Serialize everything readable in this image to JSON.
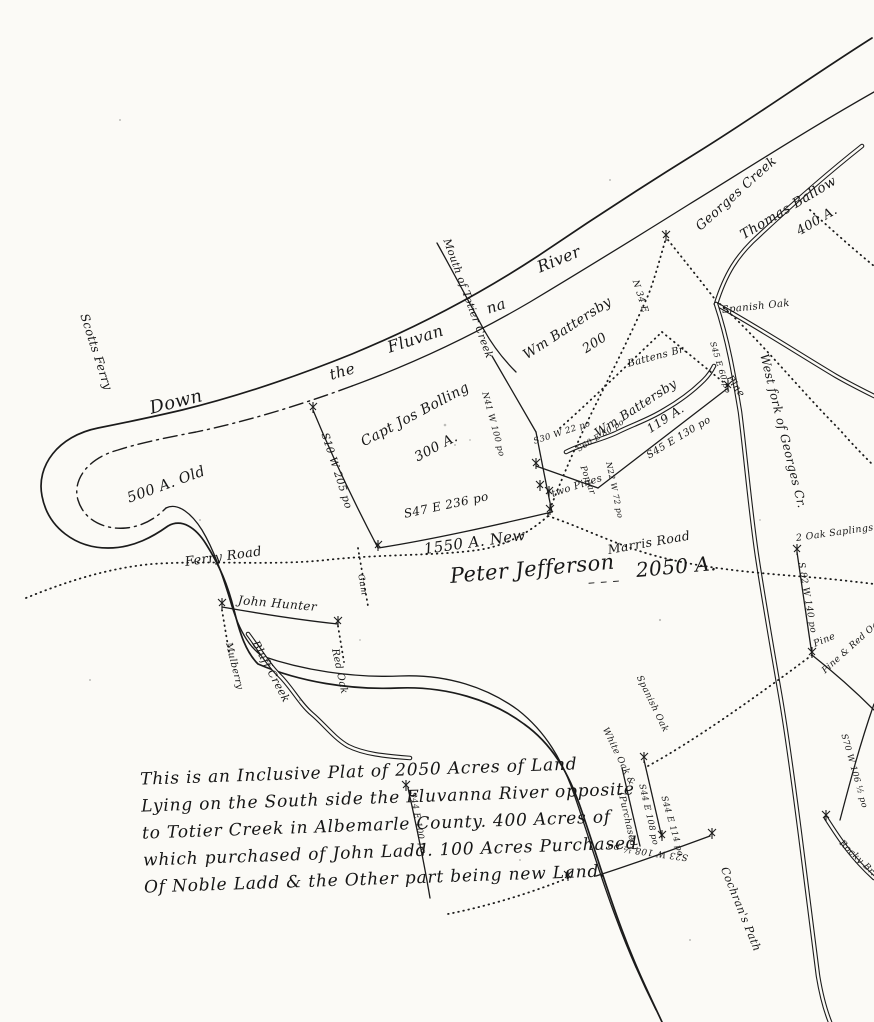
{
  "map": {
    "background_color": "#fbfaf6",
    "ink_color": "#1b1b1b",
    "note_lines": [
      "This is an Inclusive Plat of 2050 Acres of Land",
      "Lying on the South side the Fluvanna River opposite",
      "to Totier Creek in Albemarle County. 400 Acres of",
      "which purchased of John Ladd. 100 Acres Purchased",
      "Of Noble Ladd & the Other part being new Land."
    ],
    "labels": [
      {
        "name": "river-word-down",
        "text": "Down",
        "x": 150,
        "y": 400,
        "rot": -14,
        "fs": 18
      },
      {
        "name": "river-word-the",
        "text": "the",
        "x": 330,
        "y": 368,
        "rot": -16,
        "fs": 15
      },
      {
        "name": "river-word-fluvan",
        "text": "Fluvan",
        "x": 388,
        "y": 340,
        "rot": -18,
        "fs": 16
      },
      {
        "name": "river-word-na",
        "text": "na",
        "x": 487,
        "y": 302,
        "rot": -18,
        "fs": 15
      },
      {
        "name": "river-word-river",
        "text": "River",
        "x": 538,
        "y": 260,
        "rot": -22,
        "fs": 16
      },
      {
        "name": "scotts-ferry-label",
        "text": "Scotts Ferry",
        "x": 84,
        "y": 308,
        "rot": 72,
        "fs": 12
      },
      {
        "name": "totier-creek-label",
        "text": "Mouth of Totier Creek",
        "x": 446,
        "y": 234,
        "rot": 70,
        "fs": 10.5
      },
      {
        "name": "georges-creek-label",
        "text": "Georges Creek",
        "x": 698,
        "y": 222,
        "rot": -42,
        "fs": 13
      },
      {
        "name": "thomas-ballow-name",
        "text": "Thomas Ballow",
        "x": 742,
        "y": 230,
        "rot": -31,
        "fs": 13.5
      },
      {
        "name": "thomas-ballow-acres",
        "text": "400 A.",
        "x": 798,
        "y": 226,
        "rot": -31,
        "fs": 13
      },
      {
        "name": "battersby-200-name",
        "text": "Wm Battersby",
        "x": 525,
        "y": 350,
        "rot": -33,
        "fs": 13.5
      },
      {
        "name": "battersby-200-acres",
        "text": "200",
        "x": 584,
        "y": 344,
        "rot": -33,
        "fs": 13
      },
      {
        "name": "bearing-n34e",
        "text": "N 34 E",
        "x": 634,
        "y": 276,
        "rot": 72,
        "fs": 9
      },
      {
        "name": "spanish-oak-label",
        "text": "Spanish Oak",
        "x": 722,
        "y": 306,
        "rot": -6,
        "fs": 10
      },
      {
        "name": "bearing-s45e60",
        "text": "S45 E 60 po",
        "x": 712,
        "y": 338,
        "rot": 73,
        "fs": 8
      },
      {
        "name": "pine-upper-label",
        "text": "Pine",
        "x": 728,
        "y": 372,
        "rot": 55,
        "fs": 10
      },
      {
        "name": "west-fork-label",
        "text": "West fork of Georges Cr.",
        "x": 764,
        "y": 348,
        "rot": 76,
        "fs": 12
      },
      {
        "name": "battens-branch-label",
        "text": "Battens Br.",
        "x": 628,
        "y": 360,
        "rot": -15,
        "fs": 10
      },
      {
        "name": "battersby-119-name",
        "text": "Wm Battersby",
        "x": 596,
        "y": 428,
        "rot": -33,
        "fs": 12.5
      },
      {
        "name": "battersby-119-acres",
        "text": "119 A.",
        "x": 648,
        "y": 424,
        "rot": -33,
        "fs": 12
      },
      {
        "name": "bearing-s45e130",
        "text": "S45 E 130 po",
        "x": 648,
        "y": 452,
        "rot": -31,
        "fs": 10
      },
      {
        "name": "bolling-name",
        "text": "Capt Jos Bolling",
        "x": 362,
        "y": 436,
        "rot": -28,
        "fs": 14
      },
      {
        "name": "bolling-acres",
        "text": "300 A.",
        "x": 416,
        "y": 452,
        "rot": -28,
        "fs": 13.5
      },
      {
        "name": "bearing-s10w205",
        "text": "S10 W 205 po",
        "x": 324,
        "y": 428,
        "rot": 72,
        "fs": 10.5
      },
      {
        "name": "bearing-n41w100",
        "text": "N41 W 100 po",
        "x": 484,
        "y": 388,
        "rot": 75,
        "fs": 8.5
      },
      {
        "name": "bearing-s30w22",
        "text": "S30 W 22 po",
        "x": 534,
        "y": 438,
        "rot": -18,
        "fs": 8.5
      },
      {
        "name": "bearing-s60e80",
        "text": "S60 E 80 po",
        "x": 578,
        "y": 446,
        "rot": -32,
        "fs": 8
      },
      {
        "name": "poplar-label",
        "text": "Poplar",
        "x": 582,
        "y": 462,
        "rot": 70,
        "fs": 8.5
      },
      {
        "name": "bearing-n22w72",
        "text": "N22 W 72 po",
        "x": 608,
        "y": 458,
        "rot": 78,
        "fs": 8
      },
      {
        "name": "old-500-label",
        "text": "500 A. Old",
        "x": 128,
        "y": 492,
        "rot": -20,
        "fs": 14.5
      },
      {
        "name": "bearing-s47e236",
        "text": "S47 E 236 po",
        "x": 404,
        "y": 508,
        "rot": -12,
        "fs": 12
      },
      {
        "name": "two-pines-label",
        "text": "two Pines",
        "x": 552,
        "y": 490,
        "rot": -18,
        "fs": 10
      },
      {
        "name": "new-1550-label",
        "text": "1550 A. New",
        "x": 424,
        "y": 542,
        "rot": -8,
        "fs": 15
      },
      {
        "name": "peter-jefferson-label",
        "text": "Peter Jefferson",
        "x": 450,
        "y": 566,
        "rot": -5,
        "fs": 21
      },
      {
        "name": "peter-jefferson-dashes",
        "text": "– – –",
        "x": 588,
        "y": 576,
        "rot": -4,
        "fs": 14
      },
      {
        "name": "acres-2050-label",
        "text": "2050 A.",
        "x": 636,
        "y": 560,
        "rot": -5,
        "fs": 20
      },
      {
        "name": "ferry-road-label",
        "text": "Ferry Road",
        "x": 185,
        "y": 556,
        "rot": -8,
        "fs": 13
      },
      {
        "name": "marris-road-label",
        "text": "Marris Road",
        "x": 608,
        "y": 544,
        "rot": -10,
        "fs": 12.5
      },
      {
        "name": "gum-label",
        "text": "Gum",
        "x": 360,
        "y": 570,
        "rot": 80,
        "fs": 8.5
      },
      {
        "name": "john-hunter-label",
        "text": "John Hunter",
        "x": 238,
        "y": 594,
        "rot": 5,
        "fs": 12
      },
      {
        "name": "mulberry-label",
        "text": "Mulberry",
        "x": 228,
        "y": 638,
        "rot": 76,
        "fs": 9.5
      },
      {
        "name": "bluff-creek-label",
        "text": "Bluff Creek",
        "x": 255,
        "y": 636,
        "rot": 62,
        "fs": 11
      },
      {
        "name": "red-oak-label",
        "text": "Red Oak",
        "x": 334,
        "y": 644,
        "rot": 78,
        "fs": 10
      },
      {
        "name": "oak-saplings-label",
        "text": "2 Oak Saplings",
        "x": 796,
        "y": 534,
        "rot": -8,
        "fs": 9.5
      },
      {
        "name": "bearing-s82w140",
        "text": "S 82 W 140 po",
        "x": 800,
        "y": 558,
        "rot": 80,
        "fs": 9
      },
      {
        "name": "pine-mid-label",
        "text": "Pine",
        "x": 814,
        "y": 640,
        "rot": -22,
        "fs": 9.5
      },
      {
        "name": "pine-red-oak-label",
        "text": "Pine & Red Oak",
        "x": 824,
        "y": 668,
        "rot": -42,
        "fs": 9
      },
      {
        "name": "bearing-s70w106",
        "text": "S70 W 106 ½ po",
        "x": 843,
        "y": 730,
        "rot": 74,
        "fs": 8.5
      },
      {
        "name": "rocky-branch-label",
        "text": "Rocky Br.",
        "x": 840,
        "y": 838,
        "rot": 44,
        "fs": 9
      },
      {
        "name": "white-oak-label",
        "text": "White Oak &",
        "x": 604,
        "y": 724,
        "rot": 64,
        "fs": 9
      },
      {
        "name": "spanish-oak-2-label",
        "text": "Spanish Oak",
        "x": 638,
        "y": 672,
        "rot": 64,
        "fs": 9
      },
      {
        "name": "purchased-label",
        "text": "(Purchased)",
        "x": 620,
        "y": 788,
        "rot": 77,
        "fs": 9
      },
      {
        "name": "bearing-s44e108",
        "text": "S44 E 108 po",
        "x": 641,
        "y": 780,
        "rot": 77,
        "fs": 8.5
      },
      {
        "name": "bearing-s44e114",
        "text": "S44 E 114 po",
        "x": 663,
        "y": 792,
        "rot": 74,
        "fs": 8.5
      },
      {
        "name": "bearing-s23w108",
        "text": "S23 W 108 ½ po",
        "x": 688,
        "y": 852,
        "rot": 188,
        "fs": 9
      },
      {
        "name": "bearing-s44e100",
        "text": "S44 E 100 po",
        "x": 412,
        "y": 788,
        "rot": 80,
        "fs": 8.5
      },
      {
        "name": "cochrans-path-label",
        "text": "Cochran's Path",
        "x": 724,
        "y": 862,
        "rot": 68,
        "fs": 11
      }
    ]
  }
}
